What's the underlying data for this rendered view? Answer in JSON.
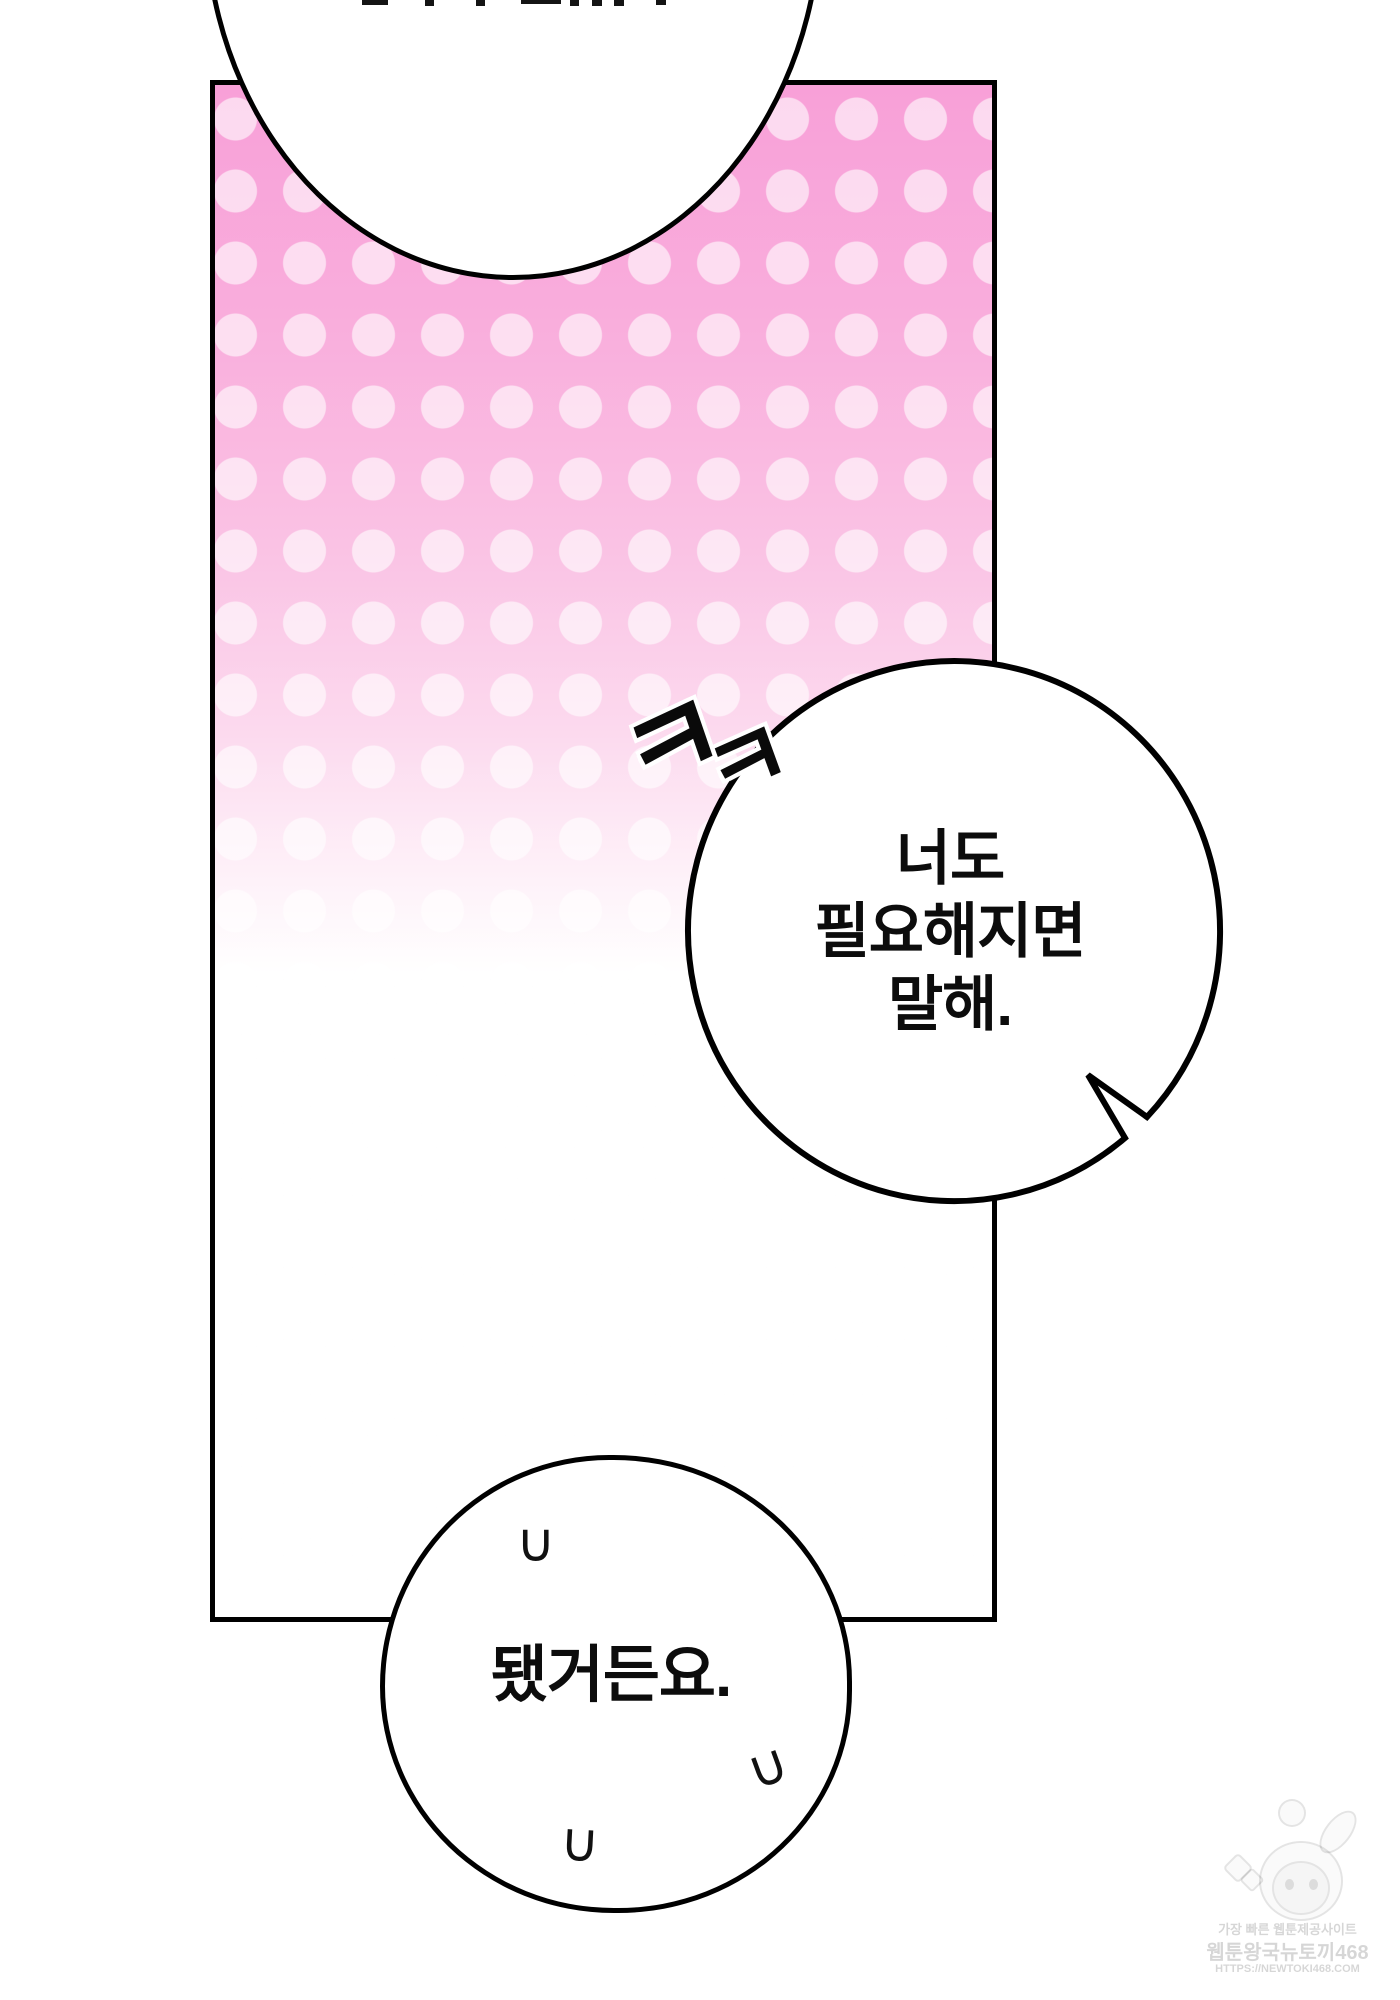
{
  "panel": {
    "border_color": "#000000",
    "pink_top_color": "#f8a0d8",
    "dot_color": "rgba(255,255,255,0.6)",
    "fade_to": "#ffffff"
  },
  "sfx_laugh": {
    "label": "ㅋㅋ",
    "chars": [
      "ㅋ",
      "ㅋ"
    ]
  },
  "speech": {
    "right": {
      "lines": [
        "너도",
        "필요해지면",
        "말해."
      ]
    },
    "bottom": {
      "text": "됐거든요.",
      "marks": [
        "∪",
        "∪",
        "∪"
      ]
    }
  },
  "watermark": {
    "line1": "가장 빠른 웹툰제공사이트",
    "line2": "웹툰왕국뉴토끼468",
    "line3": "HTTPS://NEWTOKI468.COM"
  }
}
